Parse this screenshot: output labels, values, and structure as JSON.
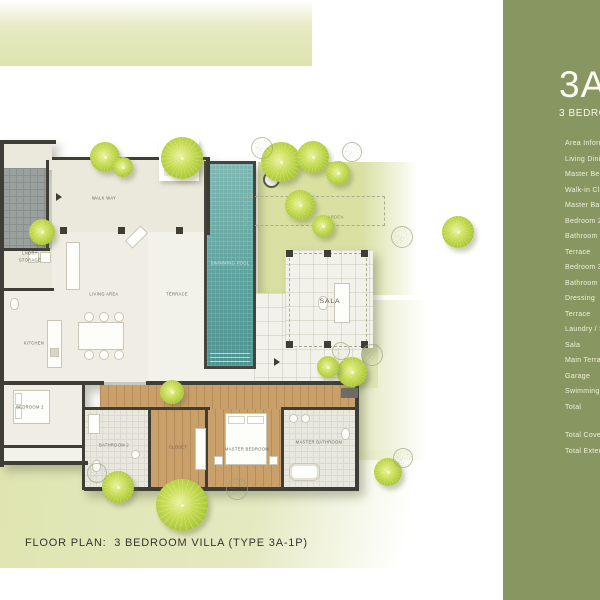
{
  "caption": "FLOOR PLAN:  3 BEDROOM VILLA (TYPE 3A-1P)",
  "sidebar": {
    "bg_color": "#889762",
    "title": "3A-1P",
    "subtitle": "3 BEDROOM VILLA",
    "area_list_header": "Area Information",
    "items": [
      "Living Dining",
      "Master Bedroom",
      "Walk-in Closet",
      "Master Bathroom",
      "Bedroom 2",
      "Bathroom 2",
      "Terrace",
      "Bedroom 3",
      "Bathroom 3",
      "Dressing",
      "Terrace",
      "Laundry / Storage",
      "Sala",
      "Main Terrace",
      "Garage",
      "Swimming Pool",
      "Total"
    ],
    "totals": [
      "Total Covered Area",
      "Total External Area"
    ]
  },
  "plan": {
    "colors": {
      "panel_olive": "#889762",
      "pool_teal": "#5ba09c",
      "tree_green": "#b5cf3f",
      "garden_light": "#dde4ae",
      "wood_floor": "#c99f6a",
      "wall_dark": "#3e3e36"
    },
    "labels": [
      {
        "text": "WALK WAY",
        "x": 104,
        "y": 199
      },
      {
        "text": "LNDRY",
        "x": 30,
        "y": 254
      },
      {
        "text": "STORAGE",
        "x": 30,
        "y": 261
      },
      {
        "text": "KITCHEN",
        "x": 34,
        "y": 344
      },
      {
        "text": "LIVING AREA",
        "x": 104,
        "y": 295
      },
      {
        "text": "TERRACE",
        "x": 177,
        "y": 295
      },
      {
        "text": "GARDEN",
        "x": 334,
        "y": 218,
        "cls": "lbl-garden"
      },
      {
        "text": "SALA",
        "x": 330,
        "y": 301,
        "cls": "lbl-sala"
      },
      {
        "text": "SWIMMING POOL",
        "x": 230,
        "y": 264,
        "cls": "lbl-pool"
      },
      {
        "text": "MASTER BEDROOM",
        "x": 247,
        "y": 450
      },
      {
        "text": "MASTER BATHROOM",
        "x": 319,
        "y": 443
      },
      {
        "text": "CLOSET",
        "x": 178,
        "y": 448
      },
      {
        "text": "BEDROOM 2",
        "x": 30,
        "y": 408
      },
      {
        "text": "BATHROOM 2",
        "x": 114,
        "y": 446
      }
    ],
    "trees": [
      {
        "x": 105,
        "y": 157,
        "r": 15
      },
      {
        "x": 123,
        "y": 167,
        "r": 10
      },
      {
        "x": 182,
        "y": 158,
        "r": 21
      },
      {
        "x": 281,
        "y": 162,
        "r": 20
      },
      {
        "x": 313,
        "y": 157,
        "r": 16
      },
      {
        "x": 338,
        "y": 173,
        "r": 12
      },
      {
        "x": 42,
        "y": 232,
        "r": 13
      },
      {
        "x": 300,
        "y": 205,
        "r": 15
      },
      {
        "x": 323,
        "y": 226,
        "r": 11
      },
      {
        "x": 458,
        "y": 232,
        "r": 16
      },
      {
        "x": 352,
        "y": 372,
        "r": 15
      },
      {
        "x": 328,
        "y": 367,
        "r": 11
      },
      {
        "x": 172,
        "y": 392,
        "r": 12
      },
      {
        "x": 118,
        "y": 487,
        "r": 16
      },
      {
        "x": 182,
        "y": 505,
        "r": 26
      },
      {
        "x": 388,
        "y": 472,
        "r": 14
      },
      {
        "x": 262,
        "y": 148,
        "r": 11,
        "outline": true
      },
      {
        "x": 352,
        "y": 152,
        "r": 10,
        "outline": true
      },
      {
        "x": 402,
        "y": 237,
        "r": 11,
        "outline": true
      },
      {
        "x": 372,
        "y": 355,
        "r": 11,
        "outline": true
      },
      {
        "x": 341,
        "y": 351,
        "r": 9,
        "outline": true
      },
      {
        "x": 237,
        "y": 489,
        "r": 11,
        "outline": true
      },
      {
        "x": 403,
        "y": 458,
        "r": 10,
        "outline": true
      },
      {
        "x": 97,
        "y": 473,
        "r": 10,
        "outline": true
      }
    ]
  }
}
